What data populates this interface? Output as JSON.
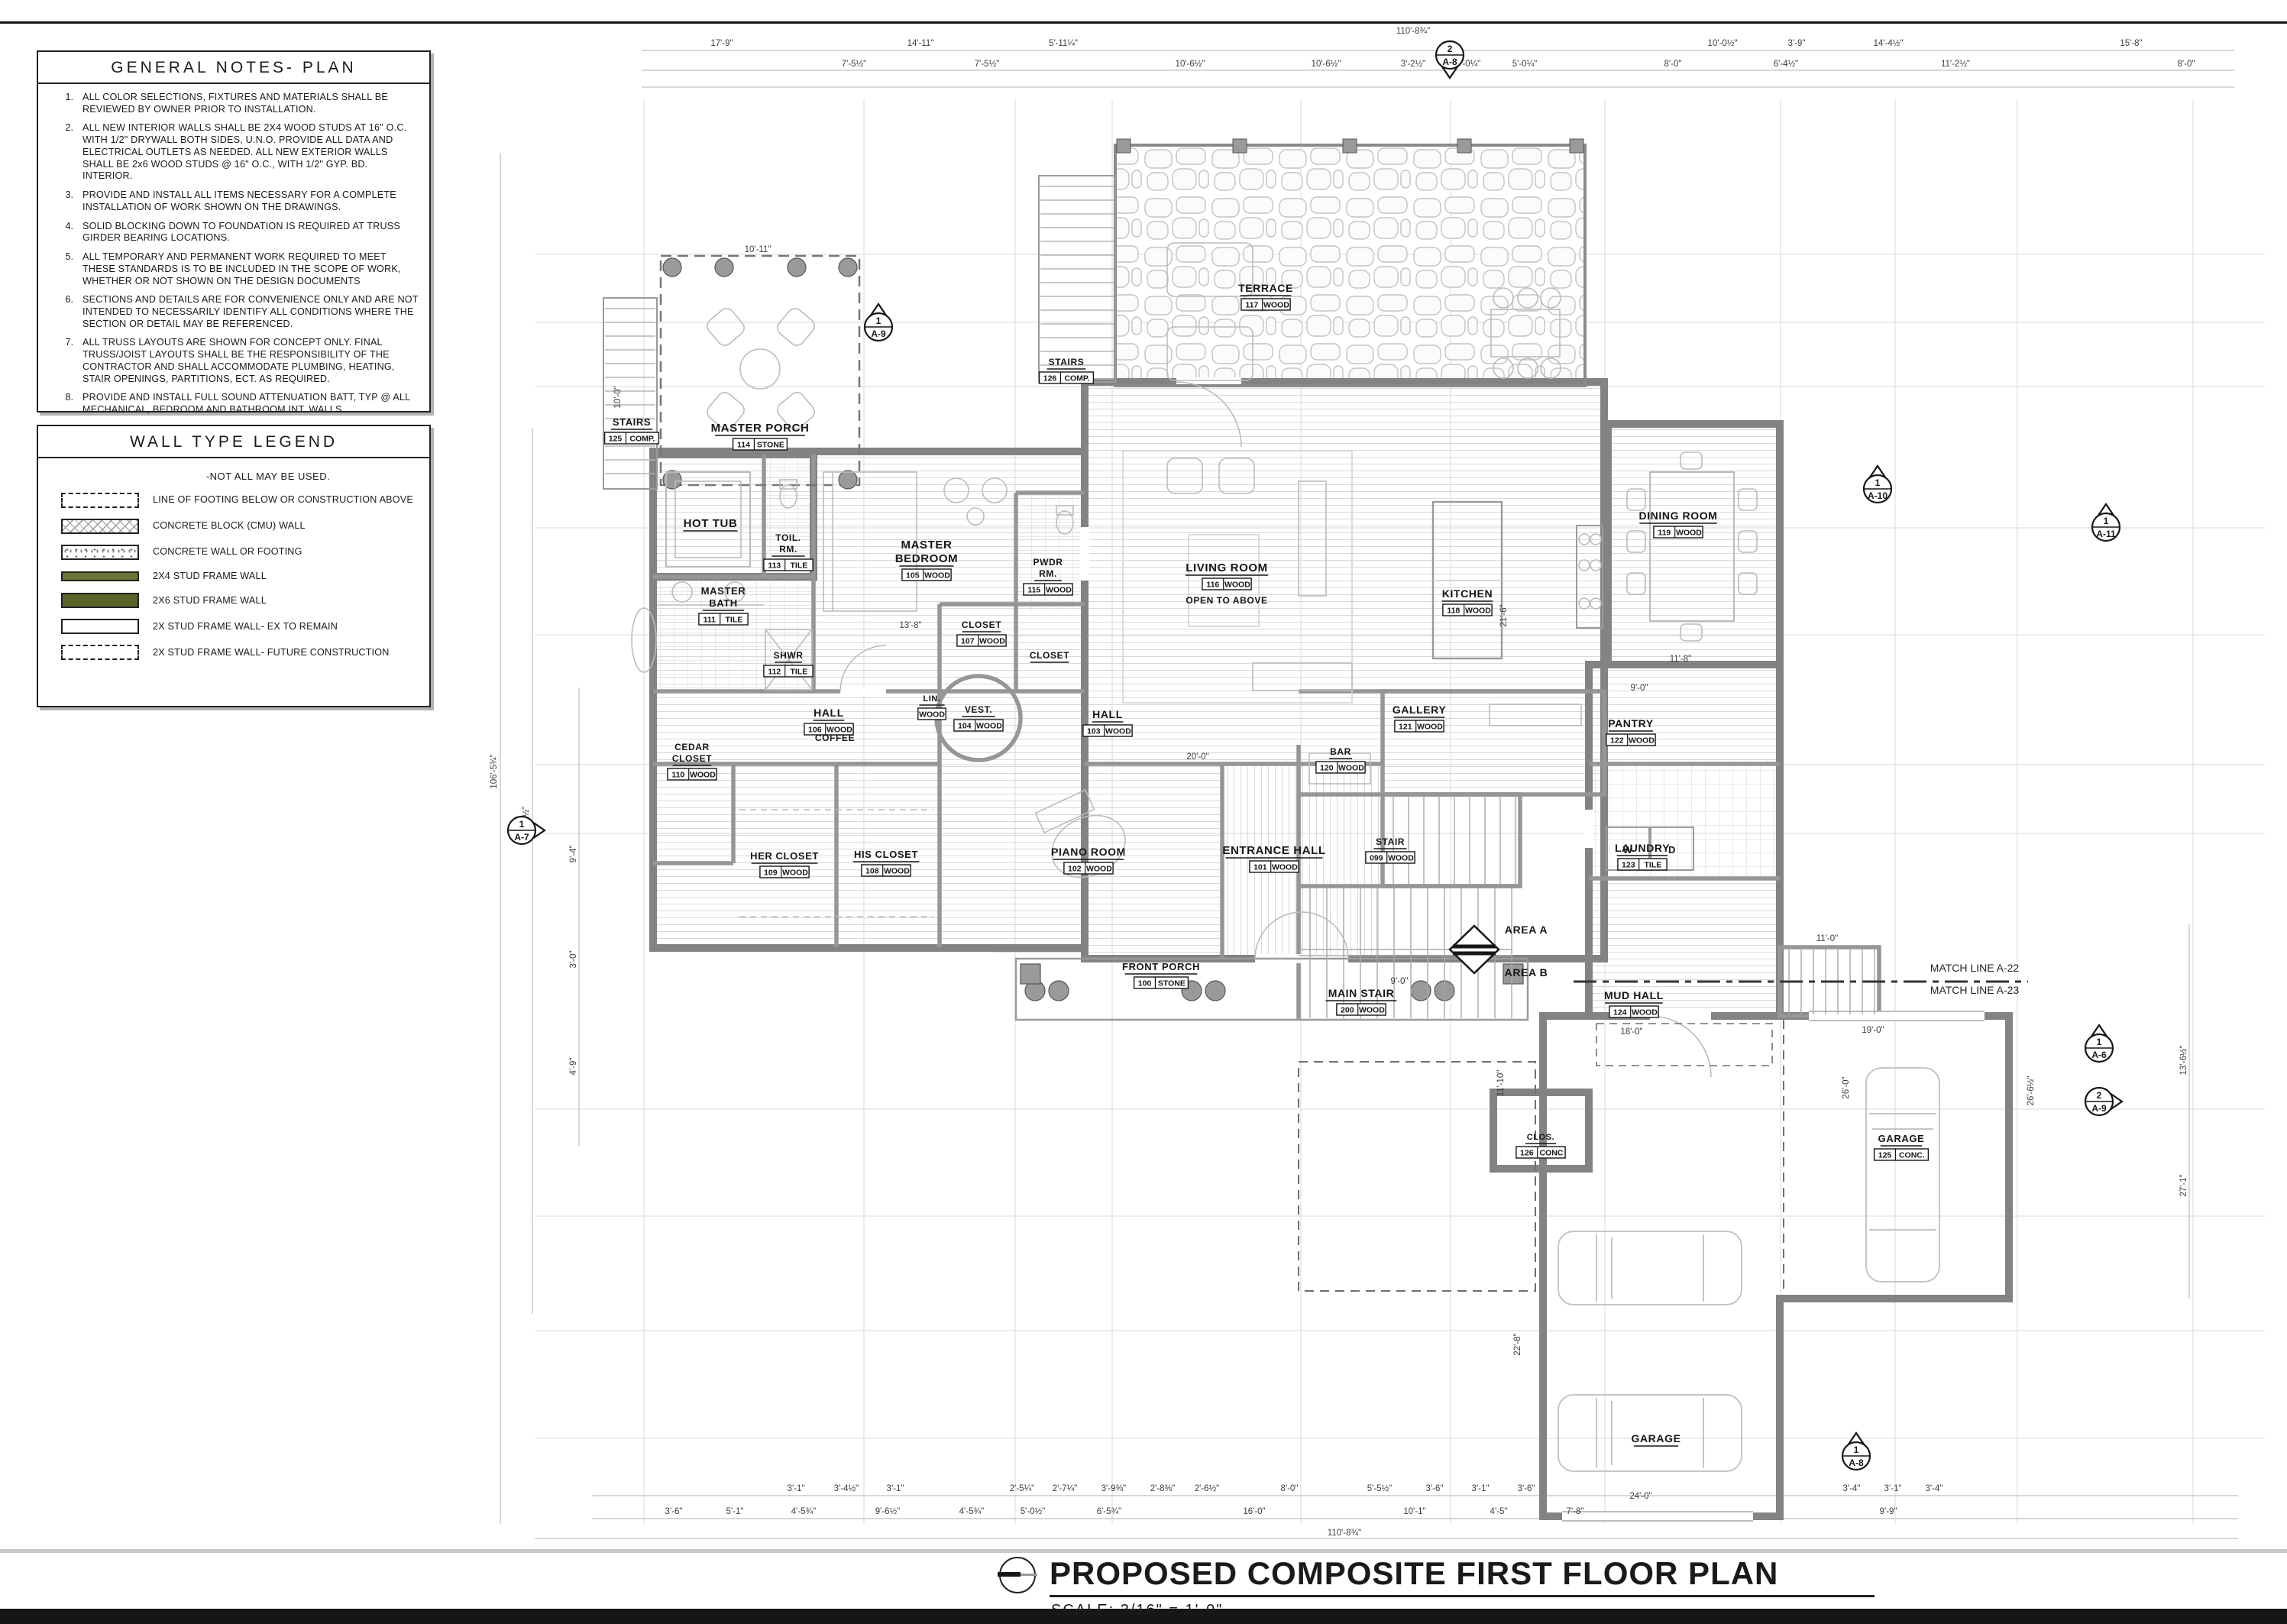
{
  "sheet": {
    "title": "PROPOSED COMPOSITE FIRST FLOOR PLAN",
    "scale": "SCALE: 3/16\" = 1'-0\""
  },
  "general_notes": {
    "title": "GENERAL NOTES- PLAN",
    "items": [
      {
        "n": "1.",
        "text": "ALL COLOR SELECTIONS, FIXTURES AND MATERIALS SHALL BE REVIEWED BY OWNER PRIOR TO INSTALLATION."
      },
      {
        "n": "2.",
        "text": "ALL NEW INTERIOR WALLS SHALL BE 2X4 WOOD STUDS AT 16\" O.C. WITH 1/2\" DRYWALL BOTH SIDES, U.N.O.  PROVIDE ALL DATA AND ELECTRICAL OUTLETS AS NEEDED. ALL NEW EXTERIOR WALLS SHALL BE 2x6 WOOD STUDS @ 16\" O.C., WITH 1/2\" GYP. BD. INTERIOR."
      },
      {
        "n": "3.",
        "text": "PROVIDE AND INSTALL ALL ITEMS NECESSARY FOR A COMPLETE INSTALLATION OF WORK SHOWN ON THE DRAWINGS."
      },
      {
        "n": "4.",
        "text": "SOLID BLOCKING DOWN TO FOUNDATION IS REQUIRED AT TRUSS GIRDER BEARING LOCATIONS."
      },
      {
        "n": "5.",
        "text": "ALL TEMPORARY AND PERMANENT WORK REQUIRED TO MEET THESE STANDARDS IS TO BE INCLUDED IN THE SCOPE OF WORK, WHETHER OR NOT SHOWN ON THE DESIGN DOCUMENTS"
      },
      {
        "n": "6.",
        "text": "SECTIONS AND  DETAILS ARE FOR CONVENIENCE ONLY AND ARE NOT INTENDED TO NECESSARILY IDENTIFY ALL CONDITIONS WHERE THE SECTION OR DETAIL MAY BE REFERENCED."
      },
      {
        "n": "7.",
        "text": "ALL TRUSS LAYOUTS ARE SHOWN FOR CONCEPT ONLY.  FINAL TRUSS/JOIST LAYOUTS SHALL BE THE RESPONSIBILITY OF THE CONTRACTOR AND SHALL ACCOMMODATE PLUMBING, HEATING, STAIR OPENINGS, PARTITIONS, ECT. AS REQUIRED."
      },
      {
        "n": "8.",
        "text": "PROVIDE AND INSTALL FULL SOUND ATTENUATION BATT, TYP @ ALL MECHANICAL, BEDROOM AND BATHROOM INT. WALLS"
      },
      {
        "n": "9.",
        "text": "PROVIDE AND INSTALL DOUBLE JOIST TYPICAL BELOW ALL KITCHEN CABINETS, ISLANDS, AND OTHER LARGE COUNTERTOPS AS NEEDED."
      },
      {
        "n": "10.",
        "text": "ACCESS DOORS FROM CONDITIONED TO UNCONDITIONED SPACE IE. ATTICS SHALL BE WEATHERSTRIPPED AND INSUL. TO EQ. WALL OR CEILING OF WHICH THE OPENING ACCESS PENETRATES."
      }
    ]
  },
  "wall_legend": {
    "title": "WALL TYPE LEGEND",
    "note": "-NOT ALL MAY BE USED.",
    "colors": {
      "stud_2x4": "#6d7434",
      "stud_2x6": "#5a6429"
    },
    "items": [
      {
        "swatch": "footing-dashed",
        "label": "LINE OF FOOTING BELOW OR CONSTRUCTION ABOVE"
      },
      {
        "swatch": "cmu",
        "label": "CONCRETE BLOCK (CMU) WALL"
      },
      {
        "swatch": "conc",
        "label": "CONCRETE WALL OR FOOTING"
      },
      {
        "swatch": "s24",
        "label": "2X4 STUD FRAME WALL"
      },
      {
        "swatch": "s26",
        "label": "2X6 STUD FRAME WALL"
      },
      {
        "swatch": "ex",
        "label": "2X STUD FRAME WALL- EX TO REMAIN"
      },
      {
        "swatch": "future",
        "label": "2X STUD FRAME WALL- FUTURE CONSTRUCTION"
      }
    ]
  },
  "plan": {
    "rooms": [
      {
        "id": "stairs-125",
        "name": "STAIRS",
        "num": "125",
        "floor": "COMP."
      },
      {
        "id": "master-porch",
        "name": "MASTER PORCH",
        "num": "114",
        "floor": "STONE"
      },
      {
        "id": "hot-tub",
        "name": "HOT TUB",
        "num": "",
        "floor": ""
      },
      {
        "id": "toil-rm",
        "name": "TOIL.\nRM.",
        "num": "113",
        "floor": "TILE"
      },
      {
        "id": "master-bath",
        "name": "MASTER\nBATH",
        "num": "111",
        "floor": "TILE"
      },
      {
        "id": "shwr",
        "name": "SHWR",
        "num": "112",
        "floor": "TILE"
      },
      {
        "id": "master-bedroom",
        "name": "MASTER\nBEDROOM",
        "num": "105",
        "floor": "WOOD"
      },
      {
        "id": "pwdr-rm",
        "name": "PWDR\nRM.",
        "num": "115",
        "floor": "WOOD"
      },
      {
        "id": "closet-master",
        "name": "CLOSET",
        "num": "107",
        "floor": "WOOD"
      },
      {
        "id": "closet-coat",
        "name": "CLOSET",
        "num": "",
        "floor": ""
      },
      {
        "id": "cedar-closet",
        "name": "CEDAR\nCLOSET",
        "num": "110",
        "floor": "WOOD"
      },
      {
        "id": "hall-106",
        "name": "HALL",
        "num": "106",
        "floor": "WOOD"
      },
      {
        "id": "lin",
        "name": "LIN.",
        "num": "",
        "floor": "WOOD"
      },
      {
        "id": "vest",
        "name": "VEST.",
        "num": "104",
        "floor": "WOOD"
      },
      {
        "id": "hall-103",
        "name": "HALL",
        "num": "103",
        "floor": "WOOD"
      },
      {
        "id": "her-closet",
        "name": "HER CLOSET",
        "num": "109",
        "floor": "WOOD"
      },
      {
        "id": "his-closet",
        "name": "HIS CLOSET",
        "num": "108",
        "floor": "WOOD"
      },
      {
        "id": "piano-room",
        "name": "PIANO ROOM",
        "num": "102",
        "floor": "WOOD"
      },
      {
        "id": "entrance-hall",
        "name": "ENTRANCE HALL",
        "num": "101",
        "floor": "WOOD"
      },
      {
        "id": "stair-099",
        "name": "STAIR",
        "num": "099",
        "floor": "WOOD"
      },
      {
        "id": "main-stair",
        "name": "MAIN STAIR",
        "num": "200",
        "floor": "WOOD"
      },
      {
        "id": "front-porch",
        "name": "FRONT PORCH",
        "num": "100",
        "floor": "STONE"
      },
      {
        "id": "living-room",
        "name": "LIVING ROOM",
        "num": "116",
        "floor": "WOOD"
      },
      {
        "id": "kitchen",
        "name": "KITCHEN",
        "num": "118",
        "floor": "WOOD"
      },
      {
        "id": "gallery",
        "name": "GALLERY",
        "num": "121",
        "floor": "WOOD"
      },
      {
        "id": "bar",
        "name": "BAR",
        "num": "120",
        "floor": "WOOD"
      },
      {
        "id": "dining-room",
        "name": "DINING ROOM",
        "num": "119",
        "floor": "WOOD"
      },
      {
        "id": "pantry",
        "name": "PANTRY",
        "num": "122",
        "floor": "WOOD"
      },
      {
        "id": "laundry",
        "name": "LAUNDRY",
        "num": "123",
        "floor": "TILE"
      },
      {
        "id": "mud-hall",
        "name": "MUD HALL",
        "num": "124",
        "floor": "WOOD"
      },
      {
        "id": "stairs-126",
        "name": "STAIRS",
        "num": "126",
        "floor": "COMP."
      },
      {
        "id": "terrace",
        "name": "TERRACE",
        "num": "117",
        "floor": "WOOD"
      },
      {
        "id": "clos-126",
        "name": "CLOS.",
        "num": "126",
        "floor": "CONC"
      },
      {
        "id": "garage-125",
        "name": "GARAGE",
        "num": "125",
        "floor": "CONC."
      },
      {
        "id": "garage-2",
        "name": "GARAGE",
        "num": "",
        "floor": ""
      }
    ],
    "extra_labels": [
      {
        "id": "coffee",
        "text": "COFFEE"
      },
      {
        "id": "open-to-above",
        "text": "OPEN TO  ABOVE"
      },
      {
        "id": "washer",
        "text": "W"
      },
      {
        "id": "dryer",
        "text": "D"
      }
    ],
    "markers": [
      {
        "num": "1",
        "sheet": "A-9"
      },
      {
        "num": "2",
        "sheet": "A-8"
      },
      {
        "num": "1",
        "sheet": "A-10"
      },
      {
        "num": "1",
        "sheet": "A-11"
      },
      {
        "num": "1",
        "sheet": "A-7"
      },
      {
        "num": "1",
        "sheet": "A-6"
      },
      {
        "num": "2",
        "sheet": "A-9"
      },
      {
        "num": "1",
        "sheet": "A-8"
      }
    ],
    "match_lines": [
      "MATCH LINE A-22",
      "MATCH LINE A-23"
    ],
    "area_labels": [
      "AREA A",
      "AREA B"
    ],
    "dimensions": {
      "top": [
        "110'-8¾\"",
        "17'-9\"",
        "14'-11\"",
        "5'-11¼\"",
        "10'-0½\"",
        "3'-9\"",
        "14'-4½\"",
        "15'-8\"",
        "7'-5½\"",
        "7'-5½\"",
        "10'-6½\"",
        "10'-6½\"",
        "3'-2½\"",
        "5'-0¼\"",
        "5'-0¼\"",
        "8'-0\"",
        "6'-4½\"",
        "11'-2½\"",
        "8'-0\""
      ],
      "bottom": [
        "3'-1\"",
        "3'-4½\"",
        "3'-1\"",
        "2'-5¼\"",
        "2'-7¼\"",
        "3'-9⅜\"",
        "2'-8⅜\"",
        "2'-6½\"",
        "8'-0\"",
        "5'-5½\"",
        "3'-6\"",
        "3'-1\"",
        "3'-6\"",
        "3'-4\"",
        "3'-1\"",
        "3'-4\"",
        "3'-6\"",
        "5'-1\"",
        "4'-5¾\"",
        "9'-6½\"",
        "4'-5¾\"",
        "5'-0½\"",
        "6'-5¾\"",
        "16'-0\"",
        "10'-1\"",
        "4'-5\"",
        "7'-8\"",
        "9'-9\"",
        "110'-8¾\""
      ],
      "left": [
        "106'-5¾\"",
        "8'-8½\"",
        "10'-0\"",
        "9'-4\"",
        "3'-0\"",
        "4'-9\""
      ],
      "right": [
        "13'-6½\"",
        "27'-1\"",
        "26'-6½\"",
        "26'-0\"",
        "22'-8\"",
        "11'-10\""
      ],
      "inner": [
        "20'-0\"",
        "13'-8\"",
        "11'-8\"",
        "9'-0\"",
        "19'-0\"",
        "24'-0\"",
        "9'-0\"",
        "11'-0\"",
        "10'-11\"",
        "18'-0\"",
        "21'-6\""
      ]
    }
  }
}
